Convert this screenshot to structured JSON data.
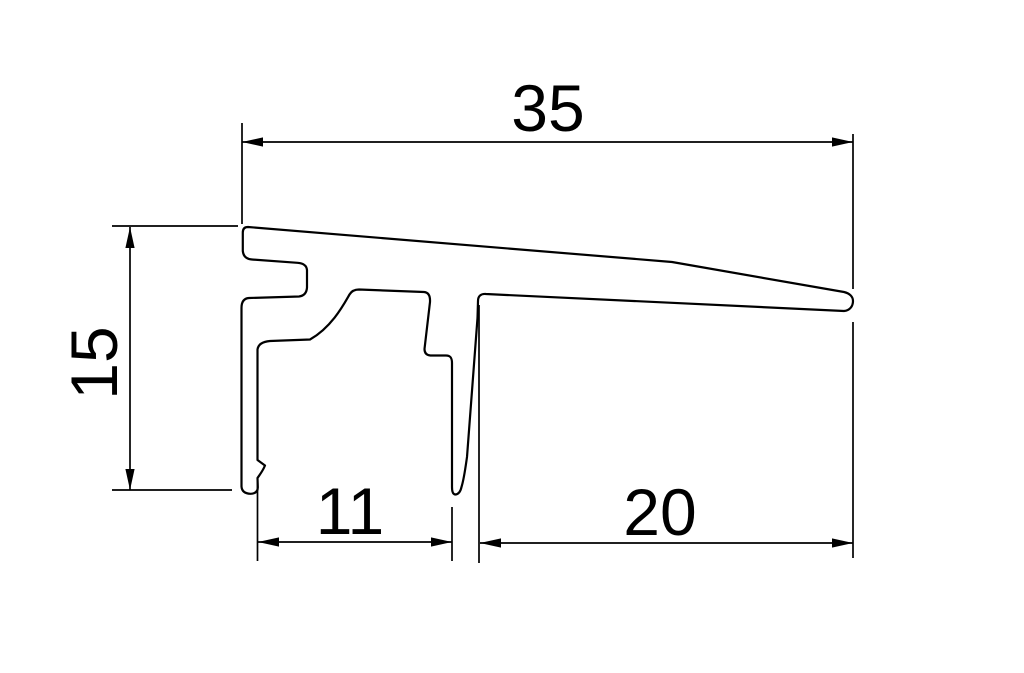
{
  "drawing": {
    "kind": "technical-drawing-profile-cross-section",
    "background_color": "#ffffff",
    "line_color": "#000000",
    "dims": {
      "top": {
        "label": "35",
        "value": 35,
        "orientation": "horizontal"
      },
      "left": {
        "label": "15",
        "value": 15,
        "orientation": "vertical"
      },
      "bottom_inner": {
        "label": "11",
        "value": 11,
        "orientation": "horizontal"
      },
      "bottom_right": {
        "label": "20",
        "value": 20,
        "orientation": "horizontal"
      }
    }
  }
}
